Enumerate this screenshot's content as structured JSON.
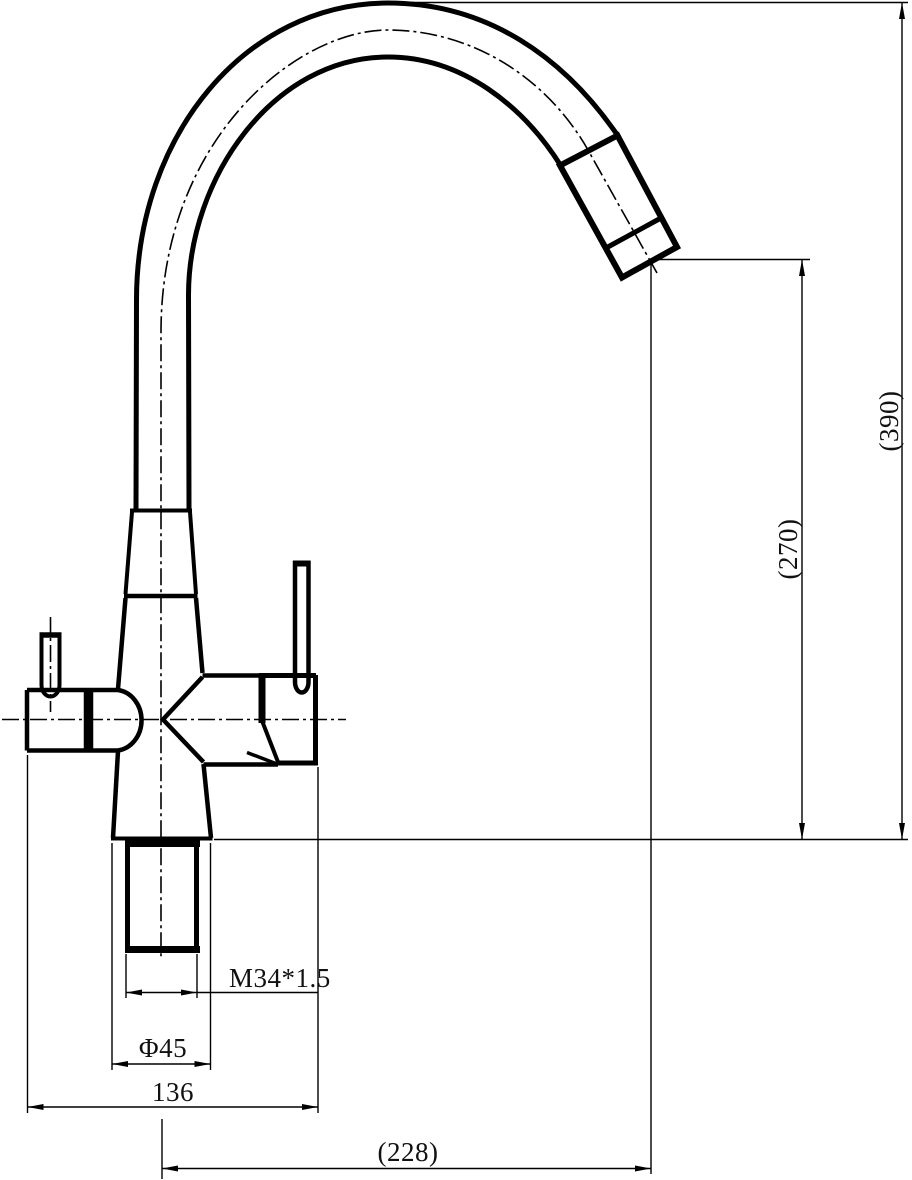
{
  "page": {
    "background": "#ffffff",
    "line_color": "#000000"
  },
  "drawing": {
    "dimensions": {
      "overall_height": "(390)",
      "outlet_height": "(270)",
      "outlet_reach": "(228)",
      "overall_width": "136",
      "base_diameter": "Φ45",
      "thread": "M34*1.5"
    }
  }
}
